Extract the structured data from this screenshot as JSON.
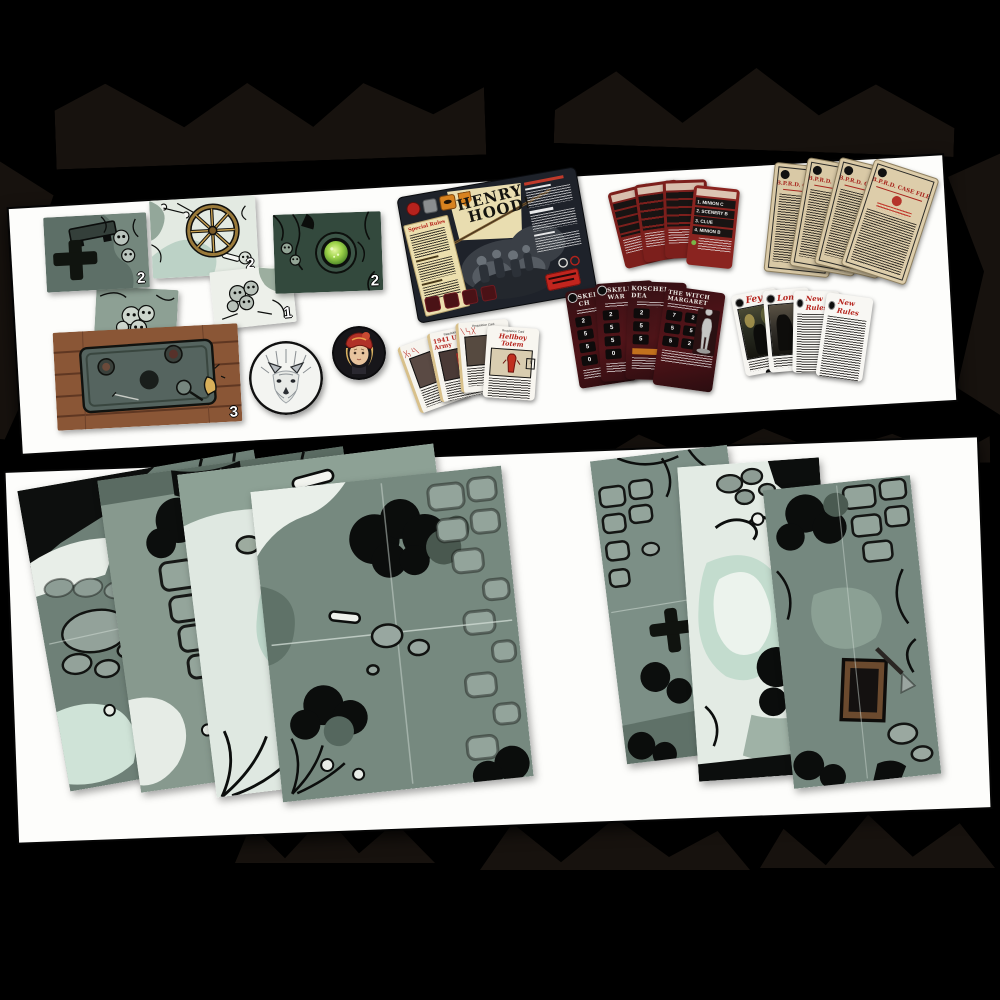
{
  "colors": {
    "accent_red": "#b5231c",
    "parchment": "#e9dcae",
    "board_dark": "#1e222a",
    "card_maroon": "#6d1a1a",
    "sage_green": "#7f948b",
    "mint": "#cfe2d8",
    "wood_brown": "#8a5636",
    "well_glow": "#9ed44a"
  },
  "top_panel": {
    "tiles": [
      {
        "name": "grave-cross-tile",
        "count": "2"
      },
      {
        "name": "skull-pile-green-tile",
        "count": "1"
      },
      {
        "name": "cartwheel-tile",
        "count": "2"
      },
      {
        "name": "skull-pile-white-tile",
        "count": "1"
      },
      {
        "name": "glowing-well-tile",
        "count": "2"
      },
      {
        "name": "wooden-table-tile",
        "count": "3"
      }
    ],
    "tokens": [
      {
        "name": "white-wolf-token"
      },
      {
        "name": "girl-portrait-token"
      }
    ],
    "henry_hood_board": {
      "title_line_1": "HENRY",
      "title_line_2": "HOOD!",
      "special_rules_header": "Special Rules"
    },
    "spawn_cards": {
      "front_rows": [
        "1. MINION C",
        "2. SCENERY B",
        "3. CLUE",
        "4. MINION B"
      ]
    },
    "profile_cards": {
      "titles": [
        "SKELETON CH",
        "SKELETON WAR",
        "KOSCHEI DEA",
        "THE WITCH MARGARET"
      ],
      "skeleton_stats": [
        "2",
        "5",
        "5",
        "0"
      ],
      "margaret_stats": [
        "7",
        "2",
        "5",
        "5",
        "5",
        "2"
      ]
    },
    "requisition_cards": {
      "header": "Requisition Card",
      "army_title": "1941 US Army",
      "totem_title": "Hellboy Totem"
    },
    "story_cards": {
      "fey_title": "Fey",
      "london_title": "Lond",
      "new_rules_title": "New Rules"
    },
    "case_file_cards": {
      "header": "B.P.R.D. CASE FILE"
    }
  },
  "bottom_panel": {
    "left_board_count": "4",
    "right_board_count": "3"
  }
}
